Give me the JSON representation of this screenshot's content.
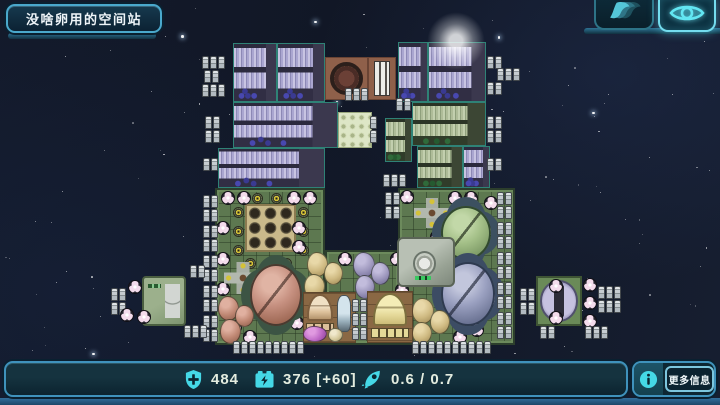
{
  "header": {
    "title": "没啥卵用的空间站"
  },
  "topbar": {
    "buttons": [
      {
        "id": "speed",
        "icon": "wings-icon",
        "active": false
      },
      {
        "id": "overview",
        "icon": "eye-icon",
        "active": true
      }
    ]
  },
  "statusbar": {
    "shield": {
      "icon": "shield-plus-icon",
      "value": "484"
    },
    "power": {
      "icon": "battery-bolt-icon",
      "value": "376 [+60]"
    },
    "thrust": {
      "icon": "rocket-icon",
      "value": "0.6 / 0.7"
    },
    "more_info": {
      "icon": "info-icon",
      "label": "更多信息"
    }
  },
  "colors": {
    "accent_cyan": "#45d8e6",
    "panel_border_blue": "#3f92bc",
    "space_background": "#131a2b",
    "deck_green": "#5d7850",
    "module_purple": "#aaa6d0",
    "module_green": "#aebc98",
    "reactor_brown": "#8f604a"
  },
  "station": {
    "modules": [
      {
        "k": "deck",
        "x": 215,
        "y": 188,
        "w": 110,
        "h": 157
      },
      {
        "k": "deck",
        "x": 325,
        "y": 250,
        "w": 75,
        "h": 95
      },
      {
        "k": "deck",
        "x": 398,
        "y": 188,
        "w": 117,
        "h": 157
      },
      {
        "k": "rack-purple",
        "x": 233,
        "y": 43,
        "w": 44,
        "h": 59
      },
      {
        "k": "rack-purple",
        "x": 277,
        "y": 43,
        "w": 48,
        "h": 59
      },
      {
        "k": "reactor",
        "x": 325,
        "y": 57,
        "w": 43,
        "h": 43
      },
      {
        "k": "chimney",
        "x": 368,
        "y": 57,
        "w": 28,
        "h": 43
      },
      {
        "k": "rack-purple",
        "x": 398,
        "y": 42,
        "w": 30,
        "h": 60
      },
      {
        "k": "rack-purple",
        "x": 428,
        "y": 42,
        "w": 58,
        "h": 60
      },
      {
        "k": "rack-purple",
        "x": 233,
        "y": 102,
        "w": 105,
        "h": 46
      },
      {
        "k": "dotplate",
        "x": 338,
        "y": 112,
        "w": 34,
        "h": 36
      },
      {
        "k": "rack-green",
        "x": 385,
        "y": 118,
        "w": 27,
        "h": 44
      },
      {
        "k": "rack-green",
        "x": 412,
        "y": 102,
        "w": 74,
        "h": 44
      },
      {
        "k": "rack-purple",
        "x": 218,
        "y": 148,
        "w": 107,
        "h": 40
      },
      {
        "k": "rack-green",
        "x": 417,
        "y": 146,
        "w": 46,
        "h": 42
      },
      {
        "k": "rack-purple",
        "x": 463,
        "y": 146,
        "w": 27,
        "h": 42
      },
      {
        "k": "tangrid",
        "x": 245,
        "y": 204,
        "w": 51,
        "h": 48
      },
      {
        "k": "ybtn",
        "x": 233,
        "y": 207
      },
      {
        "k": "ybtn",
        "x": 233,
        "y": 226
      },
      {
        "k": "ybtn",
        "x": 233,
        "y": 245
      },
      {
        "k": "ybtn",
        "x": 298,
        "y": 207
      },
      {
        "k": "ybtn",
        "x": 298,
        "y": 226
      },
      {
        "k": "ybtn",
        "x": 298,
        "y": 245
      },
      {
        "k": "ybtn",
        "x": 252,
        "y": 193
      },
      {
        "k": "ybtn",
        "x": 271,
        "y": 193
      },
      {
        "k": "ybtn",
        "x": 245,
        "y": 258
      },
      {
        "k": "ybtn",
        "x": 281,
        "y": 258
      },
      {
        "k": "trefoil",
        "x": 221,
        "y": 191
      },
      {
        "k": "trefoil",
        "x": 237,
        "y": 191
      },
      {
        "k": "trefoil",
        "x": 287,
        "y": 191
      },
      {
        "k": "trefoil",
        "x": 303,
        "y": 191
      },
      {
        "k": "trefoil",
        "x": 216,
        "y": 221
      },
      {
        "k": "trefoil",
        "x": 216,
        "y": 252
      },
      {
        "k": "trefoil",
        "x": 216,
        "y": 282
      },
      {
        "k": "trefoil",
        "x": 292,
        "y": 221
      },
      {
        "k": "trefoil",
        "x": 292,
        "y": 240
      },
      {
        "k": "trefoil",
        "x": 228,
        "y": 320
      },
      {
        "k": "trefoil",
        "x": 243,
        "y": 330
      },
      {
        "k": "trefoil",
        "x": 290,
        "y": 316
      },
      {
        "k": "trefoil",
        "x": 338,
        "y": 252
      },
      {
        "k": "trefoil",
        "x": 390,
        "y": 252
      },
      {
        "k": "trefoil",
        "x": 395,
        "y": 283
      },
      {
        "k": "trefoil",
        "x": 400,
        "y": 190
      },
      {
        "k": "trefoil",
        "x": 448,
        "y": 191
      },
      {
        "k": "trefoil",
        "x": 464,
        "y": 191
      },
      {
        "k": "trefoil",
        "x": 484,
        "y": 196
      },
      {
        "k": "trefoil",
        "x": 487,
        "y": 223
      },
      {
        "k": "trefoil",
        "x": 487,
        "y": 293
      },
      {
        "k": "trefoil",
        "x": 470,
        "y": 323
      },
      {
        "k": "trefoil",
        "x": 453,
        "y": 330
      },
      {
        "k": "trefoil",
        "x": 430,
        "y": 230
      },
      {
        "k": "cross-emblem",
        "x": 224,
        "y": 262,
        "w": 38,
        "h": 32
      },
      {
        "k": "cross-emblem",
        "x": 414,
        "y": 198,
        "w": 36,
        "h": 30
      },
      {
        "k": "dish dish-salmon",
        "x": 250,
        "y": 264,
        "w": 52,
        "h": 62
      },
      {
        "k": "dish dish-green",
        "x": 441,
        "y": 206,
        "w": 50,
        "h": 54
      },
      {
        "k": "dish dish-blue",
        "x": 441,
        "y": 262,
        "w": 54,
        "h": 64
      },
      {
        "k": "machine",
        "x": 397,
        "y": 237,
        "w": 58,
        "h": 50
      },
      {
        "k": "pod pod-tan",
        "x": 307,
        "y": 252,
        "w": 21,
        "h": 25
      },
      {
        "k": "pod pod-tan",
        "x": 324,
        "y": 262,
        "w": 19,
        "h": 23
      },
      {
        "k": "pod pod-tan",
        "x": 304,
        "y": 274,
        "w": 21,
        "h": 25
      },
      {
        "k": "pod pod-lav",
        "x": 353,
        "y": 252,
        "w": 22,
        "h": 26
      },
      {
        "k": "pod pod-lav",
        "x": 371,
        "y": 262,
        "w": 19,
        "h": 23
      },
      {
        "k": "pod pod-lav",
        "x": 355,
        "y": 275,
        "w": 20,
        "h": 24
      },
      {
        "k": "pod pod-pink",
        "x": 218,
        "y": 296,
        "w": 21,
        "h": 25
      },
      {
        "k": "pod pod-pink",
        "x": 235,
        "y": 305,
        "w": 19,
        "h": 22
      },
      {
        "k": "pod pod-pink",
        "x": 220,
        "y": 319,
        "w": 21,
        "h": 25
      },
      {
        "k": "pod pod-tan",
        "x": 412,
        "y": 298,
        "w": 22,
        "h": 26
      },
      {
        "k": "pod pod-tan",
        "x": 430,
        "y": 310,
        "w": 20,
        "h": 24
      },
      {
        "k": "pod pod-tan",
        "x": 412,
        "y": 322,
        "w": 20,
        "h": 22
      },
      {
        "k": "tile-brown",
        "x": 303,
        "y": 292,
        "w": 53,
        "h": 51
      },
      {
        "k": "dome dome-tan",
        "x": 306,
        "y": 294,
        "w": 28,
        "h": 38
      },
      {
        "k": "bottle",
        "x": 337,
        "y": 295,
        "w": 14,
        "h": 37
      },
      {
        "k": "pod pod-magenta",
        "x": 303,
        "y": 326,
        "w": 24,
        "h": 16
      },
      {
        "k": "pod pod-cream",
        "x": 328,
        "y": 328,
        "w": 15,
        "h": 14
      },
      {
        "k": "tile-brown",
        "x": 367,
        "y": 291,
        "w": 46,
        "h": 52
      },
      {
        "k": "dome dome-yellow",
        "x": 371,
        "y": 293,
        "w": 38,
        "h": 46
      },
      {
        "k": "barrels",
        "x": 202,
        "y": 56,
        "c": 3,
        "r": 1
      },
      {
        "k": "barrels",
        "x": 204,
        "y": 70,
        "c": 2,
        "r": 1
      },
      {
        "k": "barrels",
        "x": 202,
        "y": 84,
        "c": 3,
        "r": 1
      },
      {
        "k": "barrels",
        "x": 205,
        "y": 116,
        "c": 2,
        "r": 2
      },
      {
        "k": "barrels",
        "x": 203,
        "y": 158,
        "c": 2,
        "r": 1
      },
      {
        "k": "barrels",
        "x": 487,
        "y": 56,
        "c": 2,
        "r": 1
      },
      {
        "k": "barrels",
        "x": 497,
        "y": 68,
        "c": 3,
        "r": 1
      },
      {
        "k": "barrels",
        "x": 487,
        "y": 82,
        "c": 2,
        "r": 1
      },
      {
        "k": "barrels",
        "x": 487,
        "y": 116,
        "c": 2,
        "r": 2
      },
      {
        "k": "barrels",
        "x": 487,
        "y": 158,
        "c": 2,
        "r": 1
      },
      {
        "k": "barrels",
        "x": 345,
        "y": 88,
        "c": 3,
        "r": 1
      },
      {
        "k": "barrels",
        "x": 396,
        "y": 98,
        "c": 2,
        "r": 1
      },
      {
        "k": "barrels",
        "x": 370,
        "y": 116,
        "c": 1,
        "r": 2
      },
      {
        "k": "barrels",
        "x": 383,
        "y": 174,
        "c": 3,
        "r": 1
      },
      {
        "k": "barrels",
        "x": 385,
        "y": 192,
        "c": 2,
        "r": 2
      },
      {
        "k": "barrels",
        "x": 233,
        "y": 341,
        "c": 9,
        "r": 1
      },
      {
        "k": "barrels",
        "x": 412,
        "y": 341,
        "c": 10,
        "r": 1
      },
      {
        "k": "barrels",
        "x": 497,
        "y": 192,
        "c": 2,
        "r": 2
      },
      {
        "k": "barrels",
        "x": 497,
        "y": 222,
        "c": 2,
        "r": 2
      },
      {
        "k": "barrels",
        "x": 497,
        "y": 252,
        "c": 2,
        "r": 2
      },
      {
        "k": "barrels",
        "x": 497,
        "y": 282,
        "c": 2,
        "r": 2
      },
      {
        "k": "barrels",
        "x": 497,
        "y": 312,
        "c": 2,
        "r": 2
      },
      {
        "k": "barrels",
        "x": 352,
        "y": 299,
        "c": 2,
        "r": 3
      },
      {
        "k": "barrels",
        "x": 203,
        "y": 195,
        "c": 2,
        "r": 2
      },
      {
        "k": "barrels",
        "x": 203,
        "y": 225,
        "c": 2,
        "r": 2
      },
      {
        "k": "barrels",
        "x": 203,
        "y": 255,
        "c": 2,
        "r": 2
      },
      {
        "k": "barrels",
        "x": 203,
        "y": 285,
        "c": 2,
        "r": 2
      },
      {
        "k": "barrels",
        "x": 203,
        "y": 315,
        "c": 2,
        "r": 2
      },
      {
        "k": "barrels",
        "x": 111,
        "y": 288,
        "c": 2,
        "r": 2
      },
      {
        "k": "barrels",
        "x": 190,
        "y": 265,
        "c": 2,
        "r": 1
      },
      {
        "k": "sidegreen",
        "x": 142,
        "y": 276,
        "w": 44,
        "h": 50
      },
      {
        "k": "trefoil",
        "x": 128,
        "y": 280
      },
      {
        "k": "trefoil",
        "x": 120,
        "y": 308
      },
      {
        "k": "trefoil",
        "x": 137,
        "y": 310
      },
      {
        "k": "barrels",
        "x": 184,
        "y": 325,
        "c": 3,
        "r": 1
      },
      {
        "k": "sidepurple",
        "x": 536,
        "y": 276,
        "w": 46,
        "h": 50
      },
      {
        "k": "trefoil",
        "x": 549,
        "y": 279
      },
      {
        "k": "trefoil",
        "x": 549,
        "y": 311
      },
      {
        "k": "trefoil",
        "x": 583,
        "y": 278
      },
      {
        "k": "trefoil",
        "x": 583,
        "y": 296
      },
      {
        "k": "trefoil",
        "x": 583,
        "y": 314
      },
      {
        "k": "barrels",
        "x": 520,
        "y": 288,
        "c": 2,
        "r": 2
      },
      {
        "k": "barrels",
        "x": 598,
        "y": 286,
        "c": 3,
        "r": 2
      },
      {
        "k": "barrels",
        "x": 540,
        "y": 326,
        "c": 2,
        "r": 1
      },
      {
        "k": "barrels",
        "x": 585,
        "y": 326,
        "c": 3,
        "r": 1
      },
      {
        "k": "glow",
        "x": 427,
        "y": 12,
        "w": 58,
        "h": 58
      }
    ]
  }
}
